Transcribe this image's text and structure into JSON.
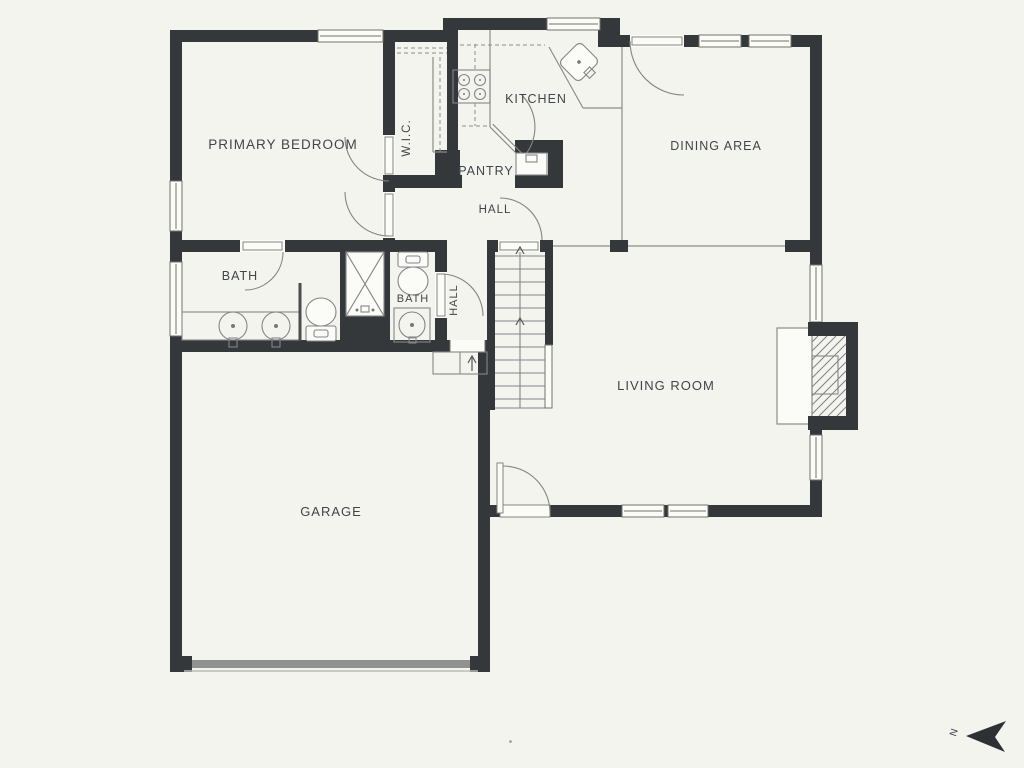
{
  "plan": {
    "type": "floor-plan",
    "labels": {
      "primary_bedroom": "PRIMARY BEDROOM",
      "wic": "W.I.C.",
      "kitchen": "KITCHEN",
      "pantry": "PANTRY",
      "dining_area": "DINING AREA",
      "hall_upper": "HALL",
      "bath_primary": "BATH",
      "bath_hall": "BATH",
      "hall_lower": "HALL",
      "living_room": "LIVING ROOM",
      "garage": "GARAGE",
      "compass_north": "N"
    },
    "fixtures": [
      "range-cooktop",
      "kitchen-corner-sink",
      "pantry-door",
      "appliance-nook",
      "closet-shelf-rod",
      "double-vanity-sinks",
      "toilet",
      "walk-in-shower",
      "toilet",
      "vanity-sink",
      "staircase-up",
      "entry-steps",
      "fireplace-with-hearth",
      "garage-door",
      "north-arrow"
    ],
    "colors": {
      "background": "#f4f4ee",
      "wall": "#35383b",
      "line": "#8e8e89",
      "text": "#41454a",
      "white": "#fbfbf7"
    }
  }
}
